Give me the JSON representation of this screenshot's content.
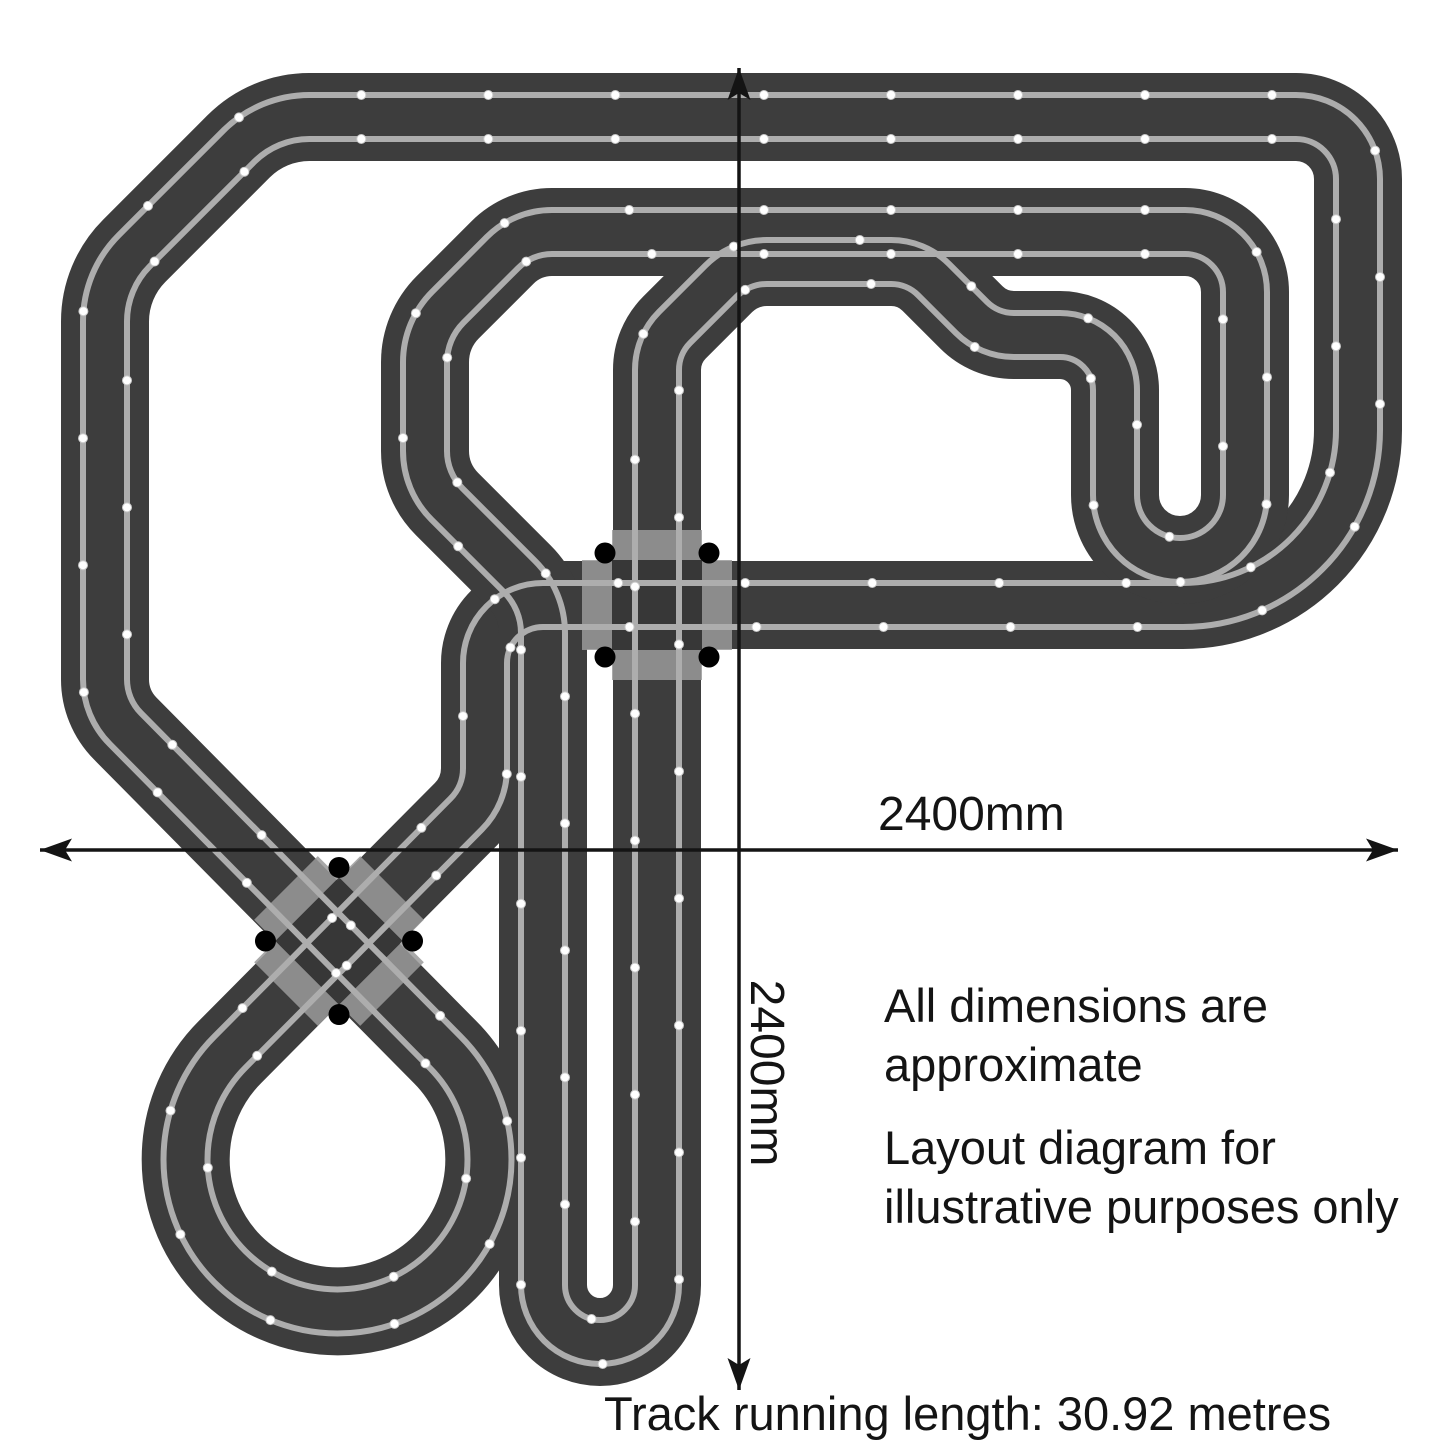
{
  "diagram": {
    "width_label": "2400mm",
    "height_label": "2400mm",
    "note_dimensions": "All dimensions are\napproximate",
    "note_illustrative": "Layout diagram for\nillustrative purposes only",
    "footer": "Track running length: 30.92 metres"
  },
  "colors": {
    "background": "#ffffff",
    "track": "#3d3d3d",
    "lane": "#adadad",
    "lane_dot": "#ffffff",
    "lane_dot_edge": "#c9c9c9",
    "crossing_patch": "#9a9a9a",
    "crossing_core": "#373737",
    "crossing_marker": "#000000",
    "dimension_line": "#141414",
    "text": "#141414"
  },
  "track": {
    "track_width": 88,
    "lane_offset": 22,
    "lane_width": 6,
    "dot_spacing": 127,
    "dot_radius": 4.5,
    "routes": [
      {
        "name": "outer-loop-figure-eight",
        "nodes": [
          {
            "x": 700,
            "y": 117
          },
          {
            "x": 1358,
            "y": 117,
            "r": 62
          },
          {
            "x": 1358,
            "y": 605,
            "r": 175
          },
          {
            "x": 485,
            "y": 605,
            "r": 58
          },
          {
            "x": 485,
            "y": 795,
            "r": 65
          },
          {
            "x": 230,
            "y": 1052
          },
          {
            "type": "arc",
            "x": 445,
            "y": 1052,
            "r": 152,
            "sweep": 0,
            "large": 1
          },
          {
            "x": 105,
            "y": 708,
            "r": 70
          },
          {
            "x": 105,
            "y": 280,
            "r": 100
          },
          {
            "x": 268,
            "y": 117,
            "r": 100
          }
        ]
      },
      {
        "name": "inner-circuit",
        "nodes": [
          {
            "x": 700,
            "y": 232
          },
          {
            "x": 1245,
            "y": 232,
            "r": 60
          },
          {
            "x": 1245,
            "y": 560,
            "r": 65
          },
          {
            "x": 1115,
            "y": 560,
            "r": 65
          },
          {
            "x": 1115,
            "y": 335,
            "r": 55
          },
          {
            "x": 989,
            "y": 335,
            "r": 60
          },
          {
            "x": 916,
            "y": 262,
            "r": 60
          },
          {
            "x": 740,
            "y": 262,
            "r": 65
          },
          {
            "x": 657,
            "y": 345,
            "r": 60
          },
          {
            "x": 657,
            "y": 1285
          },
          {
            "type": "arc",
            "x": 543,
            "y": 1285,
            "r": 57,
            "sweep": 1,
            "large": 0
          },
          {
            "x": 543,
            "y": 600,
            "r": 80
          },
          {
            "x": 425,
            "y": 482,
            "r": 75
          },
          {
            "x": 425,
            "y": 330,
            "r": 78
          },
          {
            "x": 523,
            "y": 232,
            "r": 70
          }
        ]
      }
    ],
    "crossings": [
      {
        "name": "right-angle-crossing",
        "x": 657,
        "y": 605,
        "angle": 0
      },
      {
        "name": "diagonal-crossing",
        "x": 339,
        "y": 941,
        "angle": 45
      }
    ]
  },
  "dimensions": {
    "horizontal": {
      "x1": 40,
      "x2": 1398,
      "y": 850
    },
    "vertical": {
      "x": 739,
      "y1": 68,
      "y2": 1390
    }
  }
}
